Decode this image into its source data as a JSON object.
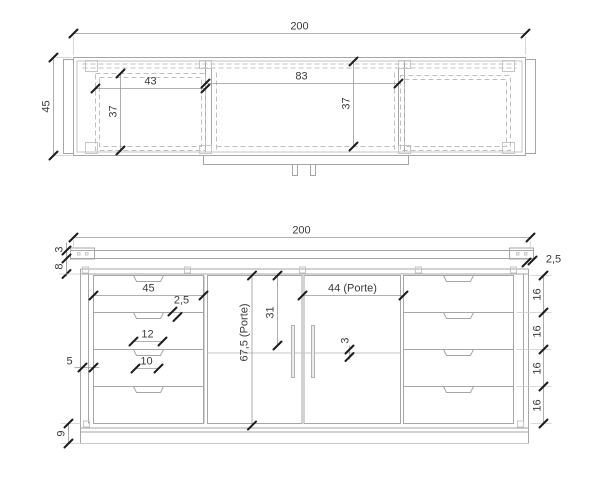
{
  "top_view": {
    "overall_width": "200",
    "overall_depth": "45",
    "left_compartment_width": "43",
    "center_compartment_width": "83",
    "left_compartment_depth": "37",
    "center_compartment_depth": "37"
  },
  "front_view": {
    "overall_width": "200",
    "top_thickness": "3",
    "top_gap": "8",
    "top_overhang": "2,5",
    "drawer_width": "45",
    "drawer_gap": "2,5",
    "handle_width_top": "12",
    "handle_width_bottom": "10",
    "side_thickness": "5",
    "plinth_height": "9",
    "door_height": "67,5 (Porte)",
    "handle_offset": "31",
    "door_width": "44 (Porte)",
    "shelf_thickness": "3",
    "drawer_heights": [
      "16",
      "16",
      "16",
      "16"
    ]
  }
}
